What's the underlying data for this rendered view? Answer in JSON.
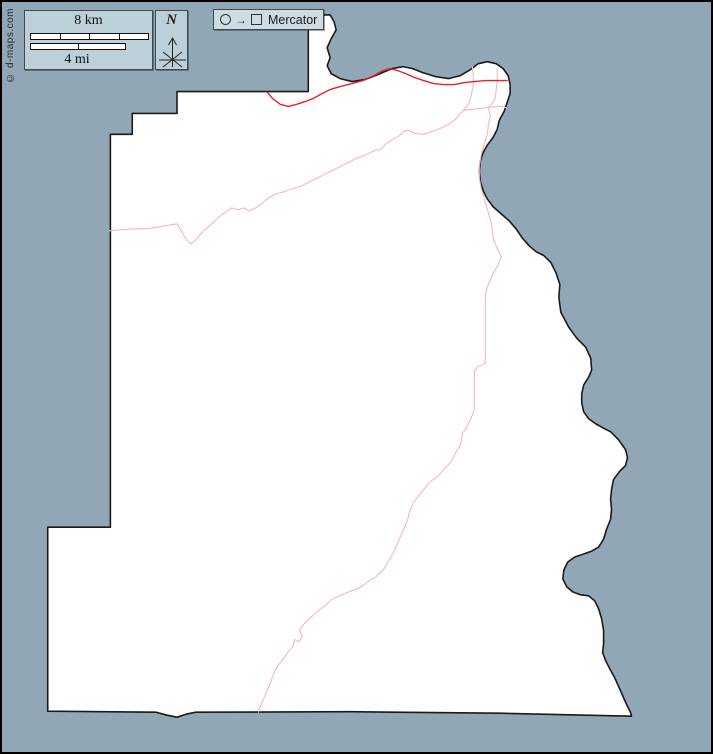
{
  "credit": {
    "text": "© d-maps.com"
  },
  "scalebar": {
    "km_label": "8 km",
    "mi_label": "4 mi",
    "km_segments": 4,
    "mi_segments": 2
  },
  "compass": {
    "north_label": "N"
  },
  "projection": {
    "label": "Mercator",
    "icon": "circle-to-square"
  },
  "colors": {
    "sea": "#92a7b5",
    "land": "#ffffff",
    "outline": "#1a1a1a",
    "road_primary": "#e62129",
    "road_secondary": "#f5b6be",
    "panel": "#bdd0da",
    "panel_light": "#cddce3",
    "frame": "#000000"
  },
  "map": {
    "land_path": "M176,90 L308,90 L308,13 L330,13 L334,20 L336,28 L331,37 L327,46 L330,56 L327,64 L331,72 L340,77 L352,80 L365,78 L378,73 L392,67 L403,65 L413,67 L423,71 L436,75 L449,77 L461,74 L471,68 L479,62 L488,60 L497,62 L504,67 L509,74 L511,83 L511,92 L508,101 L505,110 L500,119 L498,128 L494,136 L488,144 L484,151 L481,160 L480,170 L481,180 L484,190 L488,198 L494,206 L502,213 L510,220 L517,228 L523,237 L530,245 L537,251 L545,255 L552,262 L557,272 L561,284 L560,297 L562,312 L570,327 L578,338 L587,347 L592,358 L593,370 L590,377 L585,385 L583,394 L583,403 L585,412 L590,419 L597,424 L604,428 L612,432 L620,440 L627,450 L629,458 L627,466 L621,472 L615,480 L613,490 L612,500 L613,510 L612,520 L608,530 L605,540 L600,548 L593,552 L585,555 L576,558 L569,563 L565,571 L564,580 L568,588 L574,593 L582,596 L590,597 L596,602 L600,610 L603,620 L605,632 L605,645 L604,654 L607,662 L611,670 L616,679 L620,688 L624,697 L628,706 L632,714 L633,718 L500,715 L350,713.5 L195,714 L185,716 L176,719 L166,717 L155,714 L46,713 L46,528 L109,528 L109,133 L131,133 L131,112 L176,112 Z",
    "primary_road_path": "M267,91 L272,97 L280,103 L288,105 L296,103 L305,100 L313,97 L322,92 L330,88 L340,85 L352,82 L363,79 L374,74 L383,69 L390,67 L398,69 L406,72 L415,76 L424,79 L434,82 L444,83 L455,83 L465,81 L475,80 L486,79 L495,79 L508,79",
    "secondary_roads": [
      "M108,230 L120,229 L133,228 L146,228 L158,226 L170,224 L176,223 L181,231 L186,240 L190,243 L194,240 L199,234 L204,229 L211,223 L217,217 L224,212 L231,207 L237,209 L243,207 L249,210 L255,207 L261,203 L268,197 L275,193 L283,191 L291,188 L301,185 L311,180 L321,175 L331,170 L343,164 L355,158 L365,154 L373,150 L381,148 L387,142 L393,138 L399,135 L404,130 L409,129 L415,132 L424,133 L433,130 L441,127 L449,123 L456,118 L461,112 L464,109",
      "M473,65 L474,75 L474,84 L472,93 L470,101 L467,106 L464,109",
      "M464,109 L472,108 L480,107 L489,106 L497,105 L504,105 L508,107",
      "M498,68 L498,78 L497,88 L496,97 L493,102 L489,106",
      "M489,106 L491,114 L489,124 L488,133 L485,143 L482,153 L480,165 L480,177 L482,188 L485,198 L488,208 L491,218 L493,228 L494,238 L498,248 L502,256 L499,264 L494,273 L488,287 L486,295 L486,330 L486,363 L478,367 L475,372 L475,410 L471,420 L467,428 L463,434 L461,445 L457,452 L451,463 L445,469 L438,477 L431,482 L426,488 L420,495 L414,503 L410,512 L408,520 L404,530 L400,539 L395,551 L390,560 L384,570 L376,578 L368,583 L359,589 L349,593 L339,597 L331,601 L325,607 L317,613 L309,620 L303,626 L299,632 L302,637 L299,643 L294,641 L293,647 L289,652 L284,659 L277,668 L273,676 L270,684 L266,694 L262,703 L259,710 L258,714"
    ]
  }
}
